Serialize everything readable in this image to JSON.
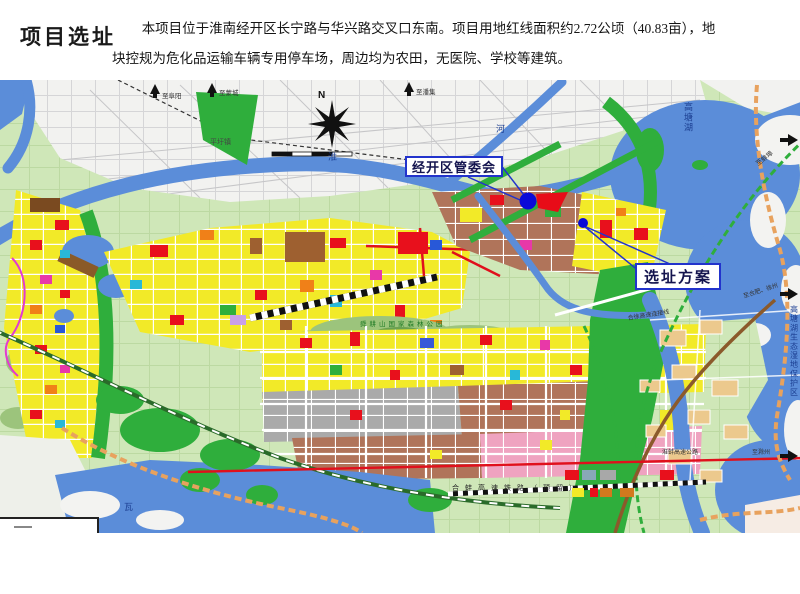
{
  "slide": {
    "title": "项目选址",
    "body": {
      "line1": "本项目位于淮南经开区长宁路与华兴路交叉口东南。项目用地红线面积约2.72公顷（40.83亩），地",
      "line2": "块控规为危化品运输车辆专用停车场，周边均为农田，无医院、学校等建筑。"
    }
  },
  "map": {
    "compass": "N",
    "callouts": {
      "committee": "经开区管委会",
      "site": "选址方案"
    },
    "labels": {
      "to_fuyang": "至阜阳",
      "to_mengcheng": "至蒙城",
      "to_panji": "至潘集",
      "pingwei": "平圩镇",
      "huai": "淮",
      "he": "河",
      "gaotang_lake": "高塘湖",
      "to_bengbu": "至蚌埠",
      "hexu_expwy": "合徐高速连接线",
      "to_hefei_xuzhou": "至合肥、徐州",
      "eco_zone": "高塘湖生态湿地保护区",
      "huaibeng_expwy": "淮蚌高速公路",
      "to_chuzhou": "至滁州",
      "hsr_reserved": "合蚌高速铁路（预留）",
      "shungeng": "舜耕山国家森林公园",
      "wabu": "瓦"
    },
    "colors": {
      "callout_border": "#2233cc",
      "marker_blue": "#0a0ad8",
      "site_wedge_red": "#e80c18"
    }
  }
}
